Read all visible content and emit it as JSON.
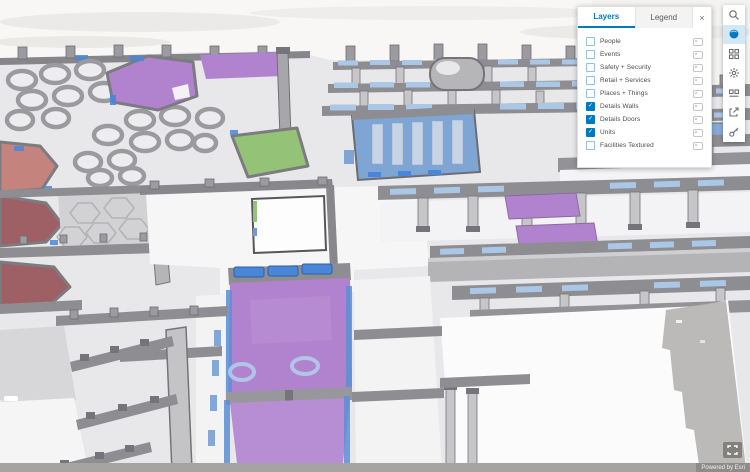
{
  "panel": {
    "tabs": [
      {
        "label": "Layers",
        "active": true
      },
      {
        "label": "Legend",
        "active": false
      }
    ],
    "close_icon": "×",
    "check_glyph": "✓",
    "layers": [
      {
        "label": "People",
        "checked": false
      },
      {
        "label": "Events",
        "checked": false
      },
      {
        "label": "Safety + Security",
        "checked": false
      },
      {
        "label": "Retail + Services",
        "checked": false
      },
      {
        "label": "Places + Things",
        "checked": false
      },
      {
        "label": "Details Walls",
        "checked": true
      },
      {
        "label": "Details Doors",
        "checked": true
      },
      {
        "label": "Units",
        "checked": true
      },
      {
        "label": "Facilities Textured",
        "checked": false
      }
    ]
  },
  "toolbar": {
    "buttons": [
      {
        "name": "search",
        "icon": "magnifier",
        "active": false
      },
      {
        "name": "basemap-globe",
        "icon": "filled-globe",
        "active": true
      },
      {
        "name": "basemap-gallery",
        "icon": "square-grid",
        "active": false
      },
      {
        "name": "settings-gear",
        "icon": "gear",
        "active": false
      },
      {
        "name": "measure",
        "icon": "two-tiles-rule",
        "active": false
      },
      {
        "name": "export",
        "icon": "box-arrow",
        "active": false
      },
      {
        "name": "key",
        "icon": "key",
        "active": false
      }
    ]
  },
  "attribution": {
    "text": "Powered by Esri"
  },
  "colors": {
    "accent_blue": "#0079c1",
    "unit_purple": "#b183cf",
    "unit_green": "#94c378",
    "unit_salmon": "#c5837e",
    "unit_maroon": "#9e6065",
    "unit_blue": "#7ea5d4",
    "glass_blue": "#aac7e6",
    "door_blue": "#4a86d8",
    "wall_gray": "#8e8e92",
    "wall_light": "#c6c6c9",
    "floor_gray": "#e8e7e9",
    "floor_white": "#f6f6f7",
    "shadow_gray": "#b6b4b2"
  }
}
